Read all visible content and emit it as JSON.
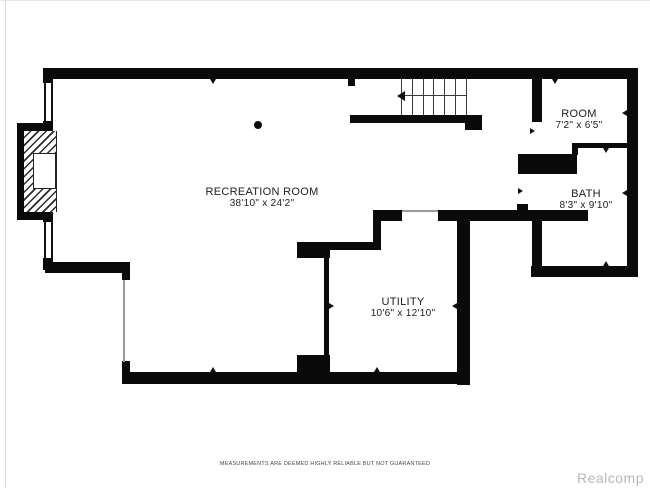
{
  "rooms": [
    {
      "id": "recreation-room",
      "name": "RECREATION ROOM",
      "dimensions": "38'10\" x 24'2\""
    },
    {
      "id": "utility",
      "name": "UTILITY",
      "dimensions": "10'6\" x 12'10\""
    },
    {
      "id": "room",
      "name": "ROOM",
      "dimensions": "7'2\" x 6'5\""
    },
    {
      "id": "bath",
      "name": "BATH",
      "dimensions": "8'3\" x 9'10\""
    }
  ],
  "footer": {
    "disclaimer": "MEASUREMENTS ARE DEEMED HIGHLY RELIABLE BUT NOT GUARANTEED",
    "watermark": "Realcomp"
  },
  "colors": {
    "wall": "#0a0a0a",
    "watermark": "#b5b9bb",
    "disclaimer": "#474747"
  }
}
